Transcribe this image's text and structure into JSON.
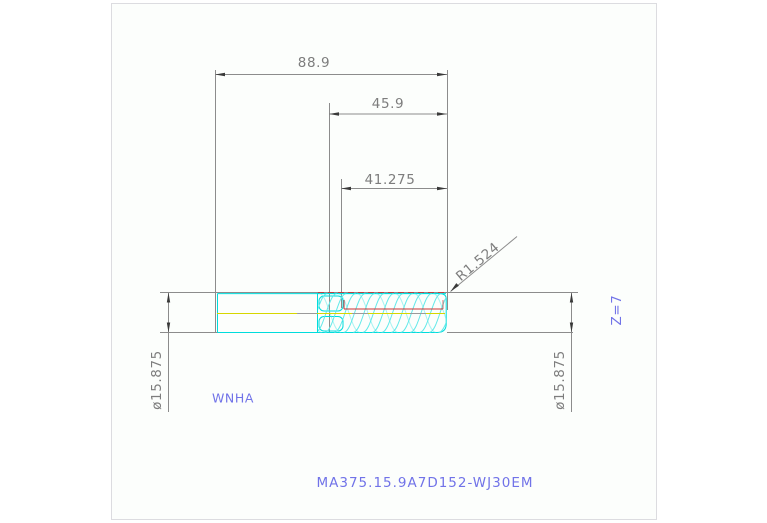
{
  "canvas": {
    "background": "#ffffff",
    "frame_fill": "#fcfefc",
    "frame_border": "#dcdce0"
  },
  "colors": {
    "dimension_lines": "#8c8c8c",
    "dimension_text": "#7d7d7d",
    "arrowhead": "#3a3a3a",
    "geometry_outline": "#00dcdc",
    "flute_hatching": "#63e9e9",
    "centerline": "#d6d600",
    "highlight_red": "#cc3333",
    "annotation_blue": "#7173e8"
  },
  "dimensions": {
    "overall_length": "88.9",
    "flute_length": "45.9",
    "effective_length": "41.275",
    "corner_radius": "R1.524",
    "shank_diameter": "ø15.875",
    "cutter_diameter": "ø15.875"
  },
  "annotations": {
    "insert_type": "WNHA",
    "flute_count": "Z=7",
    "part_number": "MA375.15.9A7D152-WJ30EM"
  }
}
